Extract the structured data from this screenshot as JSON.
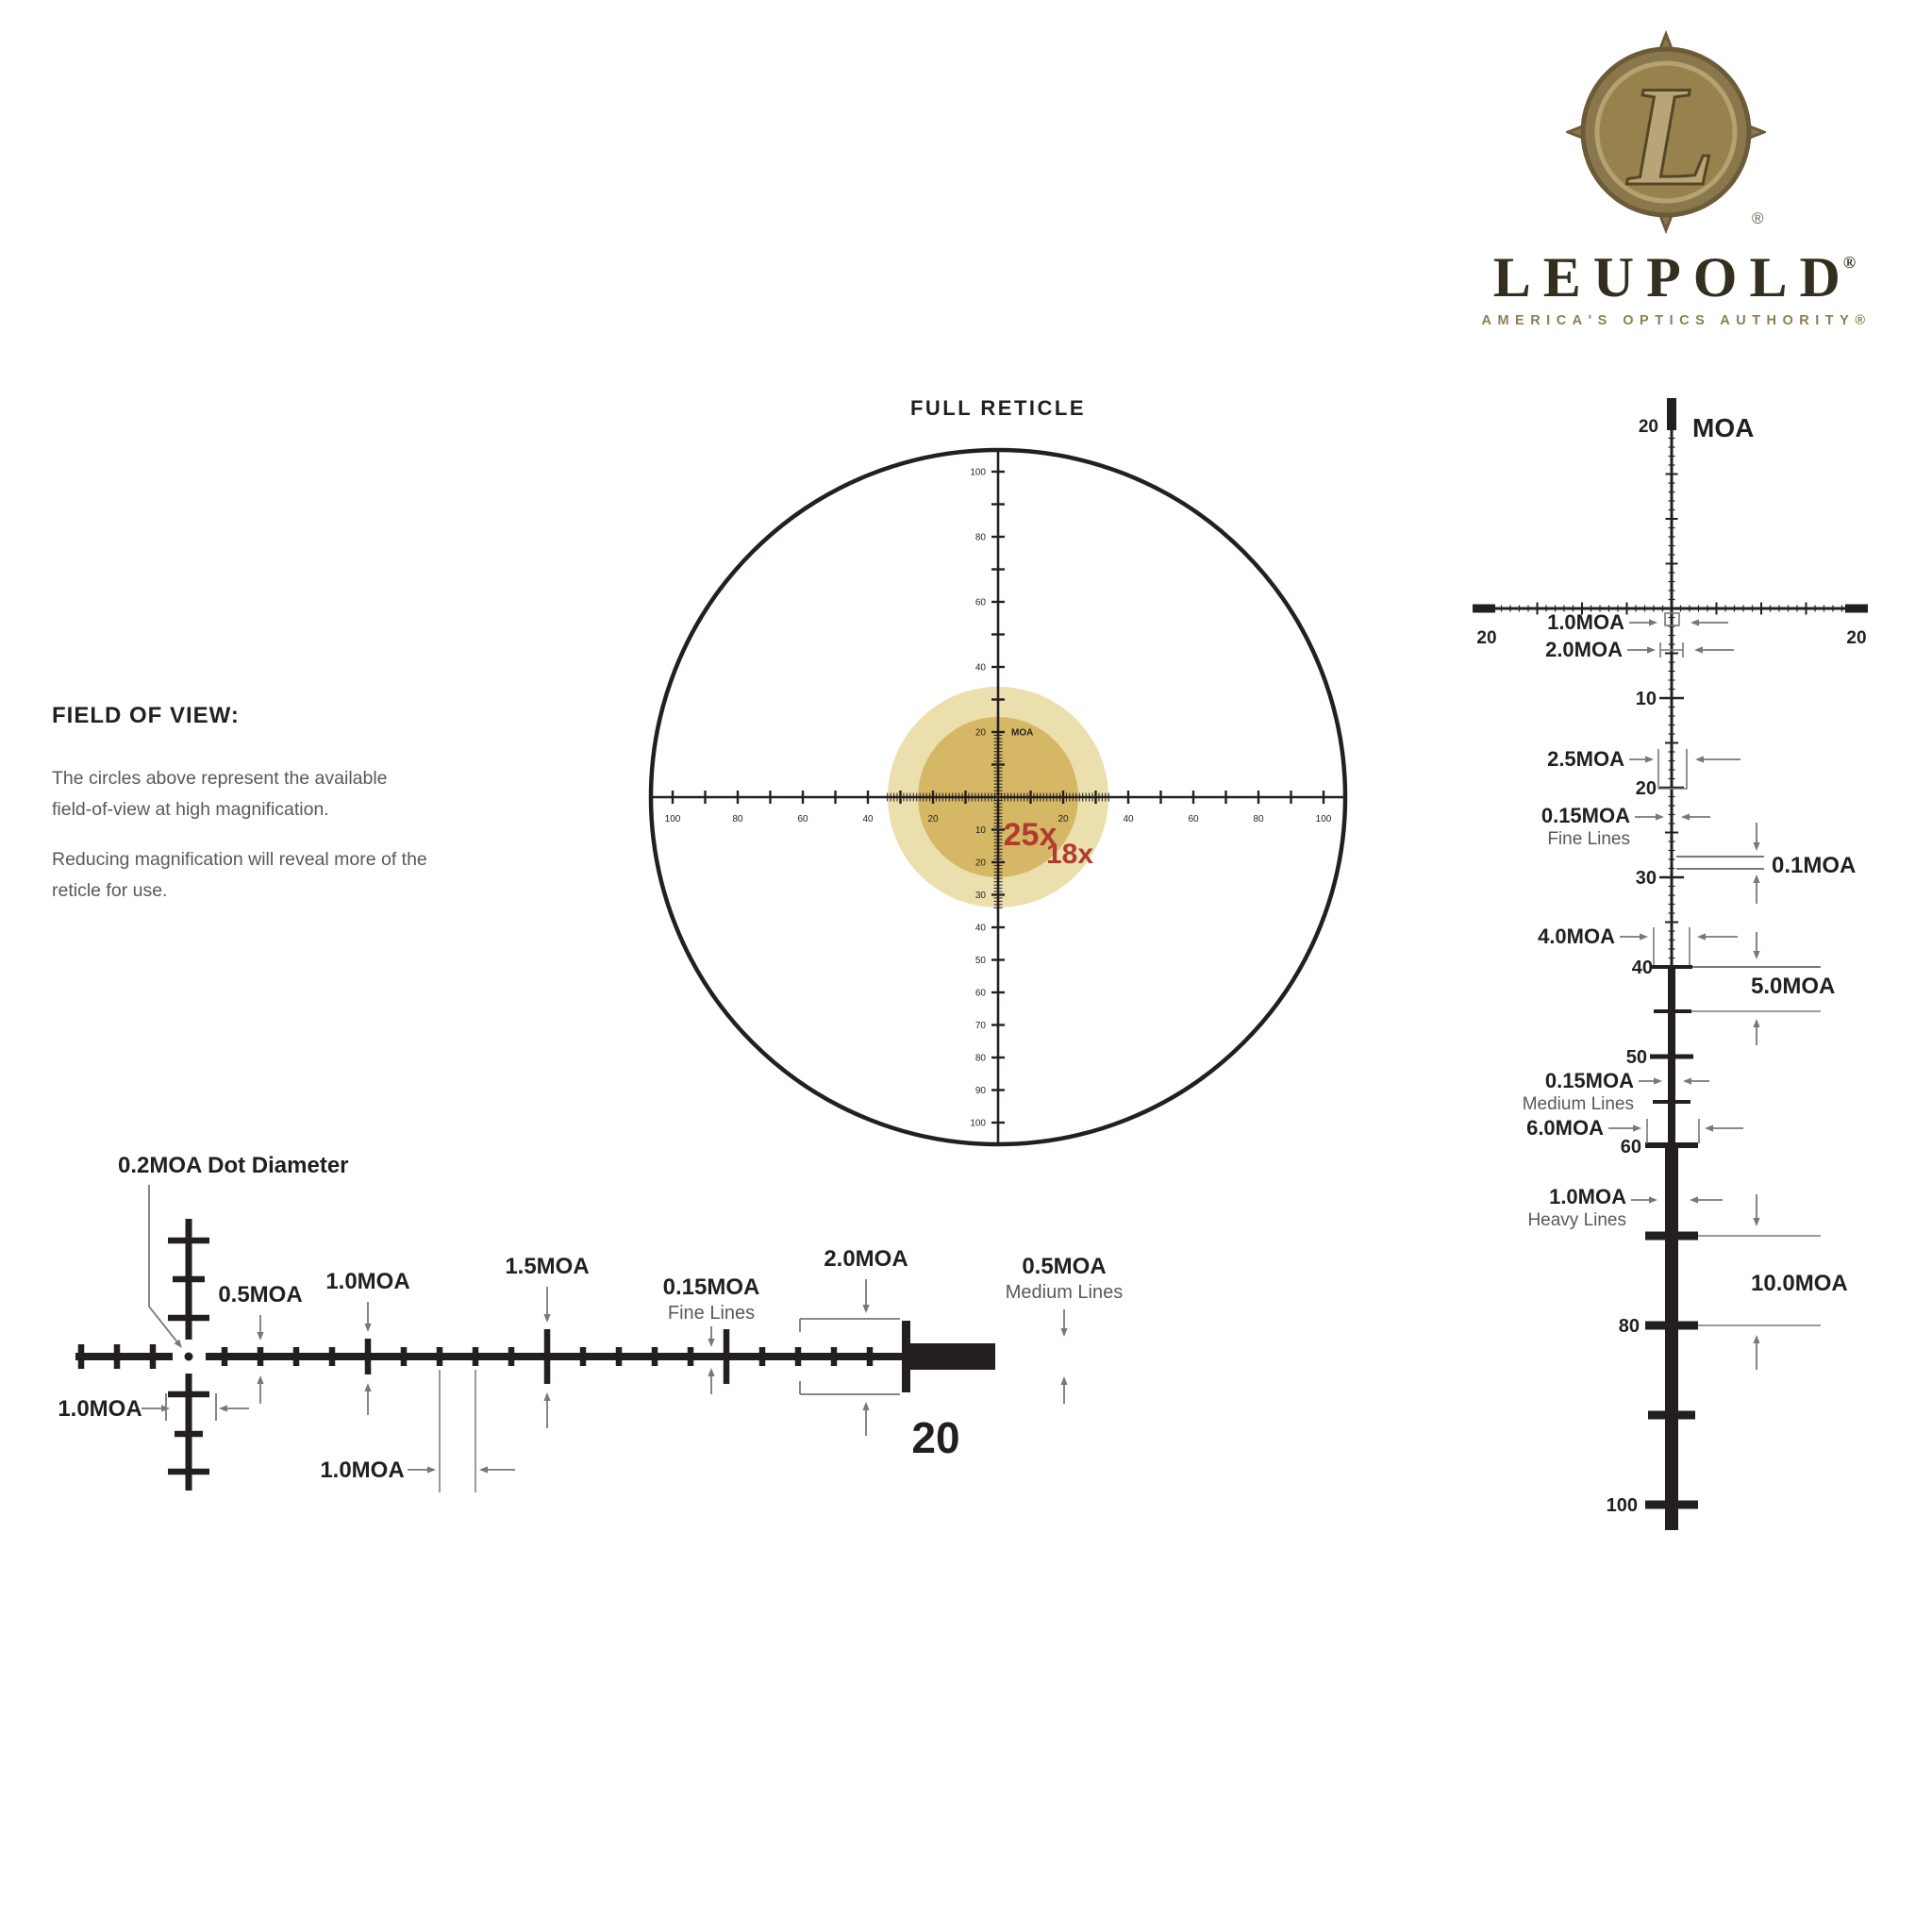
{
  "logo": {
    "monogram": "L",
    "medallion_registered": "®",
    "brand": "LEUPOLD",
    "brand_registered": "®",
    "tagline": "AMERICA'S OPTICS AUTHORITY®"
  },
  "field_of_view": {
    "title": "FIELD OF VIEW:",
    "paragraph1_line1": "The circles above represent the available",
    "paragraph1_line2": "field-of-view at high magnification.",
    "paragraph2_line1": "Reducing magnification will reveal more of the",
    "paragraph2_line2": "reticle for use."
  },
  "full_reticle": {
    "title": "FULL RETICLE",
    "magnification_inner": "25x",
    "magnification_outer": "18x",
    "unit_label": "MOA",
    "top_unit_tick_label": "20",
    "horizontal_tick_labels": [
      "20",
      "40",
      "60",
      "80",
      "100"
    ],
    "vertical_above_tick_labels": [
      "40",
      "60",
      "80",
      "100"
    ],
    "vertical_below_tick_labels": [
      "10",
      "20",
      "30",
      "40",
      "50",
      "60",
      "70",
      "80",
      "90",
      "100"
    ]
  },
  "horizontal_detail": {
    "dot_label": "0.2MOA Dot Diameter",
    "center_gap_label": "1.0MOA",
    "small_tick_label": "0.5MOA",
    "medium_tick_label": "1.0MOA",
    "tall_tick_label": "1.5MOA",
    "fine_line_label": "0.15MOA",
    "fine_line_sublabel": "Fine Lines",
    "post_height_label": "2.0MOA",
    "medium_line_label": "0.5MOA",
    "medium_line_sublabel": "Medium Lines",
    "tick_spacing_label": "1.0MOA",
    "post_position_label": "20"
  },
  "vertical_detail": {
    "unit_label": "MOA",
    "top_tick_label": "20",
    "axis_left_label": "20",
    "axis_right_label": "20",
    "scale_labels": [
      "10",
      "20",
      "30",
      "40",
      "50",
      "60",
      "80",
      "100"
    ],
    "ann_1moa": "1.0MOA",
    "ann_2moa": "2.0MOA",
    "ann_2_5moa": "2.5MOA",
    "ann_fine": "0.15MOA",
    "ann_fine_sub": "Fine Lines",
    "ann_0_1moa": "0.1MOA",
    "ann_4moa": "4.0MOA",
    "ann_5moa": "5.0MOA",
    "ann_medium": "0.15MOA",
    "ann_medium_sub": "Medium Lines",
    "ann_6moa": "6.0MOA",
    "ann_heavy": "1.0MOA",
    "ann_heavy_sub": "Heavy Lines",
    "ann_10moa": "10.0MOA"
  },
  "colors": {
    "ink": "#231f20",
    "annotation_gray": "#77787b",
    "text_gray": "#58595b",
    "accent_red": "#b23b30",
    "fov_outer": "#ecdfae",
    "fov_inner": "#d5b765",
    "bronze": "#8a774b",
    "bronze_dark": "#6b5b38",
    "bronze_face": "#97824e",
    "bronze_light": "#b4a273",
    "monogram_fill": "#b7a478",
    "monogram_edge": "#544626"
  }
}
